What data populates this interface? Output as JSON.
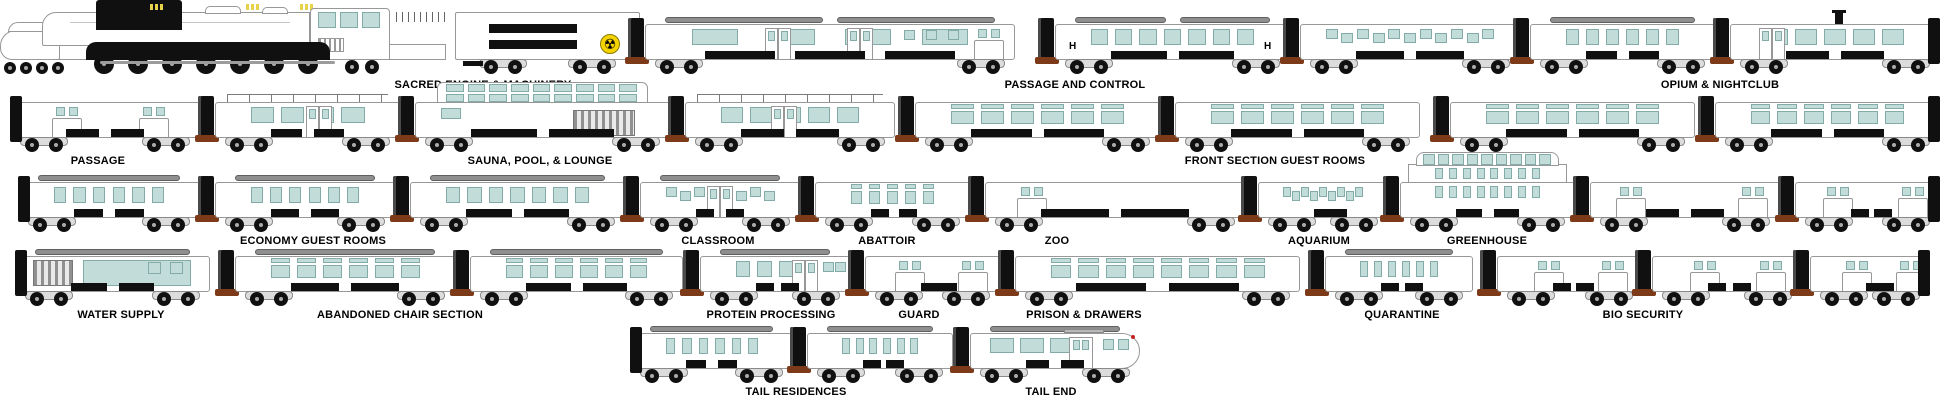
{
  "symbols": {
    "hazard": "☢",
    "hospital": "H"
  },
  "colors": {
    "window": "#c1dcd9",
    "window_border": "#83aca9",
    "body": "#ffffff",
    "outline": "#989898",
    "black": "#101010",
    "roof": "#8f8f8f",
    "coupling": "#7c3a18",
    "accent": "#e8d24a",
    "hazard_bg": "#f5d300",
    "label": "#000000"
  },
  "train": {
    "rows": [
      {
        "baseline": 74,
        "label_y": 79,
        "labels": [
          {
            "text": "SACRED ENGINE & MACHINERY",
            "cx": 483
          },
          {
            "text": "PASSAGE AND CONTROL",
            "cx": 1075
          },
          {
            "text": "OPIUM & NIGHTCLUB",
            "cx": 1720
          }
        ],
        "cars": [
          {
            "name": "sacred-engine-locomotive",
            "kind": "loco",
            "x": 0,
            "w": 450
          },
          {
            "name": "machinery-tender",
            "kind": "tender",
            "x": 455,
            "w": 185
          },
          {
            "name": "passage-control-car-1",
            "kind": "large",
            "x": 645,
            "w": 370,
            "n": 4,
            "doors": [
              0.36,
              0.58
            ],
            "sm": [
              0.7,
              0.76,
              0.82
            ],
            "units": [
              0.9
            ],
            "humps": true,
            "conn": true
          },
          {
            "name": "passage-control-car-2",
            "kind": "large",
            "x": 1055,
            "w": 235,
            "n": 7,
            "h_marks": true,
            "conn": true,
            "humps": true
          },
          {
            "name": "passage-control-car-3",
            "kind": "stagger",
            "x": 1300,
            "w": 220,
            "n": 11,
            "conn": true
          },
          {
            "name": "opium-nightclub-car-1",
            "kind": "large",
            "x": 1530,
            "w": 185,
            "n": 6,
            "conn": true,
            "humps": true
          },
          {
            "name": "opium-nightclub-car-2",
            "kind": "large",
            "x": 1730,
            "w": 210,
            "n": 5,
            "doors": [
              0.2
            ],
            "conn": true,
            "stovepipe": true,
            "cap_right": true
          }
        ]
      },
      {
        "baseline": 152,
        "label_y": 155,
        "labels": [
          {
            "text": "PASSAGE",
            "cx": 98
          },
          {
            "text": "SAUNA, POOL, & LOUNGE",
            "cx": 540
          },
          {
            "text": "FRONT SECTION GUEST ROOMS",
            "cx": 1275
          }
        ],
        "cars": [
          {
            "name": "passage-car",
            "kind": "plain",
            "x": 10,
            "w": 190,
            "units": [
              0.24,
              0.7
            ],
            "cap_left": true
          },
          {
            "name": "lounge-car-1",
            "kind": "large",
            "x": 215,
            "w": 185,
            "n": 4,
            "doors": [
              0.56
            ],
            "railing": true,
            "conn": true
          },
          {
            "name": "sauna-pool-car",
            "kind": "dome",
            "x": 415,
            "w": 255,
            "conn": true
          },
          {
            "name": "lounge-car-2",
            "kind": "large",
            "x": 685,
            "w": 210,
            "n": 5,
            "doors": [
              0.47
            ],
            "railing": true,
            "conn": true
          },
          {
            "name": "guest-room-car-1",
            "kind": "guest",
            "x": 915,
            "w": 245,
            "n": 6,
            "conn": true
          },
          {
            "name": "guest-room-car-2",
            "kind": "guest",
            "x": 1175,
            "w": 245,
            "n": 6,
            "conn": true
          },
          {
            "name": "guest-room-car-3",
            "kind": "guest",
            "x": 1450,
            "w": 245,
            "n": 6,
            "conn": true
          },
          {
            "name": "guest-room-car-4",
            "kind": "guest",
            "x": 1715,
            "w": 225,
            "n": 6,
            "conn": true,
            "cap_right": true
          }
        ]
      },
      {
        "baseline": 232,
        "label_y": 235,
        "labels": [
          {
            "text": "ECONOMY GUEST ROOMS",
            "cx": 313
          },
          {
            "text": "CLASSROOM",
            "cx": 718
          },
          {
            "text": "ABATTOIR",
            "cx": 887
          },
          {
            "text": "ZOO",
            "cx": 1057
          },
          {
            "text": "AQUARIUM",
            "cx": 1319
          },
          {
            "text": "GREENHOUSE",
            "cx": 1487
          }
        ],
        "cars": [
          {
            "name": "economy-guest-car-1",
            "kind": "large",
            "x": 18,
            "w": 182,
            "n": 6,
            "humps": true,
            "cap_left": true
          },
          {
            "name": "economy-guest-car-2",
            "kind": "large",
            "x": 215,
            "w": 180,
            "n": 6,
            "humps": true,
            "conn": true
          },
          {
            "name": "economy-guest-car-3",
            "kind": "large",
            "x": 410,
            "w": 215,
            "n": 7,
            "humps": true,
            "conn": true
          },
          {
            "name": "classroom-car",
            "kind": "stagger",
            "x": 640,
            "w": 160,
            "n": 8,
            "doors": [
              0.5
            ],
            "humps": true,
            "conn": true
          },
          {
            "name": "abattoir-car",
            "kind": "guest",
            "x": 815,
            "w": 155,
            "n": 5,
            "conn": true
          },
          {
            "name": "zoo-car",
            "kind": "plain",
            "x": 985,
            "w": 260,
            "units": [
              0.14
            ],
            "conn": true
          },
          {
            "name": "aquarium-car",
            "kind": "stagger",
            "x": 1258,
            "w": 130,
            "n": 9,
            "conn": true
          },
          {
            "name": "greenhouse-car",
            "kind": "glass",
            "x": 1400,
            "w": 175,
            "conn": true
          },
          {
            "name": "greenhouse-adjacent-car",
            "kind": "plain",
            "x": 1590,
            "w": 190,
            "units": [
              0.16,
              0.8
            ],
            "conn": true
          },
          {
            "name": "section-end-car",
            "kind": "plain",
            "x": 1795,
            "w": 145,
            "units": [
              0.22,
              0.74
            ],
            "conn": true,
            "cap_right": true
          }
        ]
      },
      {
        "baseline": 306,
        "label_y": 309,
        "labels": [
          {
            "text": "WATER SUPPLY",
            "cx": 121
          },
          {
            "text": "ABANDONED CHAIR SECTION",
            "cx": 400
          },
          {
            "text": "PROTEIN PROCESSING",
            "cx": 771
          },
          {
            "text": "GUARD",
            "cx": 919
          },
          {
            "text": "PRISON & DRAWERS",
            "cx": 1084
          },
          {
            "text": "QUARANTINE",
            "cx": 1402
          },
          {
            "text": "BIO SECURITY",
            "cx": 1643
          }
        ],
        "cars": [
          {
            "name": "water-supply-car",
            "kind": "water",
            "x": 15,
            "w": 195,
            "humps": true,
            "cap_left": true
          },
          {
            "name": "abandoned-chair-car-1",
            "kind": "guest",
            "x": 235,
            "w": 220,
            "n": 6,
            "humps": true,
            "conn": true
          },
          {
            "name": "abandoned-chair-car-2",
            "kind": "guest",
            "x": 470,
            "w": 213,
            "n": 6,
            "humps": true,
            "conn": true
          },
          {
            "name": "protein-processing-car",
            "kind": "large",
            "x": 700,
            "w": 150,
            "n": 4,
            "doors": [
              0.7
            ],
            "sm": [
              0.82,
              0.9
            ],
            "humps": true,
            "conn": true
          },
          {
            "name": "guard-car",
            "kind": "plain",
            "x": 865,
            "w": 135,
            "units": [
              0.25,
              0.72
            ],
            "conn": true
          },
          {
            "name": "prison-drawers-car",
            "kind": "guest",
            "x": 1015,
            "w": 285,
            "n": 8,
            "conn": true
          },
          {
            "name": "quarantine-car",
            "kind": "large",
            "x": 1325,
            "w": 148,
            "n": 6,
            "humps": true,
            "conn": true
          },
          {
            "name": "bio-security-car-1",
            "kind": "plain",
            "x": 1497,
            "w": 146,
            "units": [
              0.28,
              0.72
            ],
            "conn": true
          },
          {
            "name": "bio-security-car-2",
            "kind": "plain",
            "x": 1652,
            "w": 150,
            "units": [
              0.28,
              0.72
            ],
            "conn": true
          },
          {
            "name": "bio-security-car-3",
            "kind": "plain",
            "x": 1810,
            "w": 120,
            "units": [
              0.3,
              0.75
            ],
            "conn": true,
            "cap_right": true
          }
        ]
      },
      {
        "baseline": 383,
        "label_y": 386,
        "labels": [
          {
            "text": "TAIL RESIDENCES",
            "cx": 796
          },
          {
            "text": "TAIL END",
            "cx": 1051
          }
        ],
        "cars": [
          {
            "name": "tail-residence-car-1",
            "kind": "large",
            "x": 630,
            "w": 163,
            "n": 6,
            "humps": true,
            "cap_left": true
          },
          {
            "name": "tail-residence-car-2",
            "kind": "large",
            "x": 807,
            "w": 146,
            "n": 6,
            "humps": true,
            "conn": true
          },
          {
            "name": "tail-end-car",
            "kind": "tail",
            "x": 970,
            "w": 170,
            "humps": true,
            "conn": true
          }
        ]
      }
    ]
  }
}
